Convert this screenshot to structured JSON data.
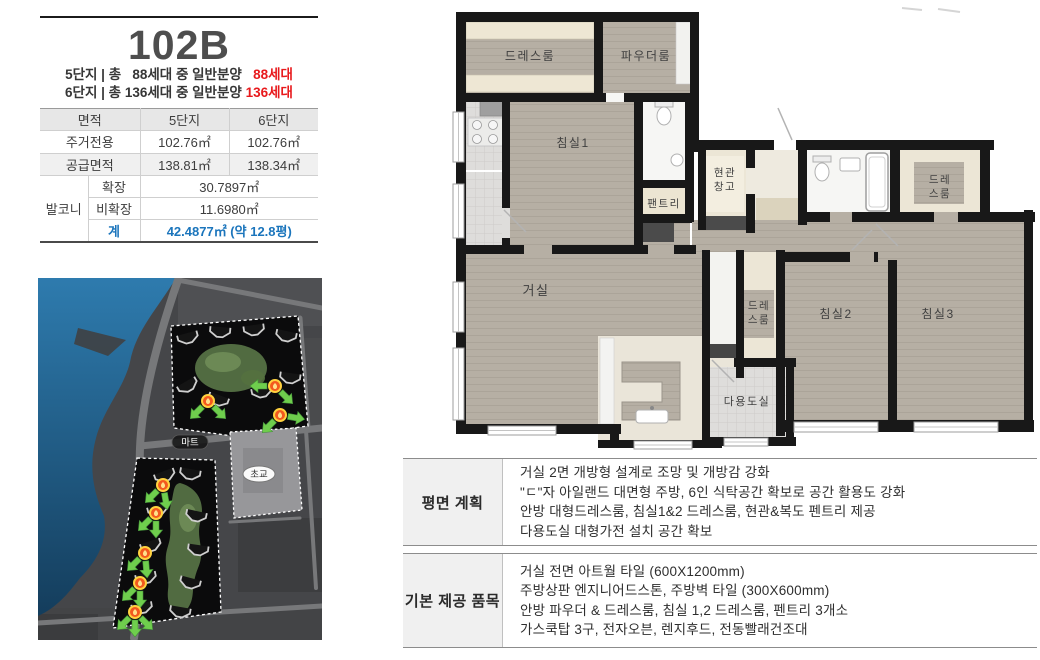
{
  "colors": {
    "highlight_red": "#e8191c",
    "highlight_blue": "#1b75bc",
    "wall": "#181818",
    "floor": "#b6afa4",
    "water": "#2e7bae"
  },
  "unit": {
    "title": "102B",
    "notice": [
      {
        "plain": "5단지 | 총   88세대 중 일반분양   ",
        "red": "88세대"
      },
      {
        "plain": "6단지 | 총 136세대 중 일반분양 ",
        "red": "136세대"
      }
    ]
  },
  "area": {
    "header": [
      "면적",
      "5단지",
      "6단지"
    ],
    "rows": [
      {
        "label": "주거전용",
        "v5": "102.76㎡",
        "v6": "102.76㎡"
      },
      {
        "label": "공급면적",
        "v5": "138.81㎡",
        "v6": "138.34㎡"
      }
    ],
    "balcony": {
      "label": "발코니",
      "rows": [
        {
          "label": "확장",
          "value": "30.7897㎡"
        },
        {
          "label": "비확장",
          "value": "11.6980㎡"
        },
        {
          "label": "계",
          "value": "42.4877㎡ (약 12.8평)"
        }
      ]
    }
  },
  "map": {
    "mart": "마트",
    "school": "초교"
  },
  "floorplan": {
    "rooms": {
      "dressroom1": "드레스룸",
      "powder": "파우더룸",
      "bedroom1": "침실1",
      "entry_storage_l1": "현관",
      "entry_storage_l2": "창고",
      "pantry": "팬트리",
      "dress_tr_l1": "드레",
      "dress_tr_l2": "스룸",
      "living": "거실",
      "dress_mid_l1": "드레",
      "dress_mid_l2": "스룸",
      "bedroom2": "침실2",
      "bedroom3": "침실3",
      "utility": "다용도실"
    }
  },
  "tables": {
    "plan": {
      "label": "평면 계획",
      "lines": [
        "거실 2면 개방형 설계로 조망 및 개방감 강화",
        "\"ㄷ\"자 아일랜드 대면형 주방, 6인 식탁공간 확보로 공간 활용도 강화",
        "안방 대형드레스룸, 침실1&2 드레스룸, 현관&복도 펜트리 제공",
        "다용도실 대형가전 설치 공간 확보"
      ]
    },
    "provide": {
      "label": "기본 제공 품목",
      "lines": [
        "거실 전면 아트월 타일 (600X1200mm)",
        "주방상판 엔지니어드스톤, 주방벽 타일 (300X600mm)",
        "안방 파우더 & 드레스룸, 침실 1,2 드레스룸, 펜트리 3개소",
        "가스쿡탑 3구, 전자오븐, 렌지후드, 전동빨래건조대"
      ]
    }
  }
}
